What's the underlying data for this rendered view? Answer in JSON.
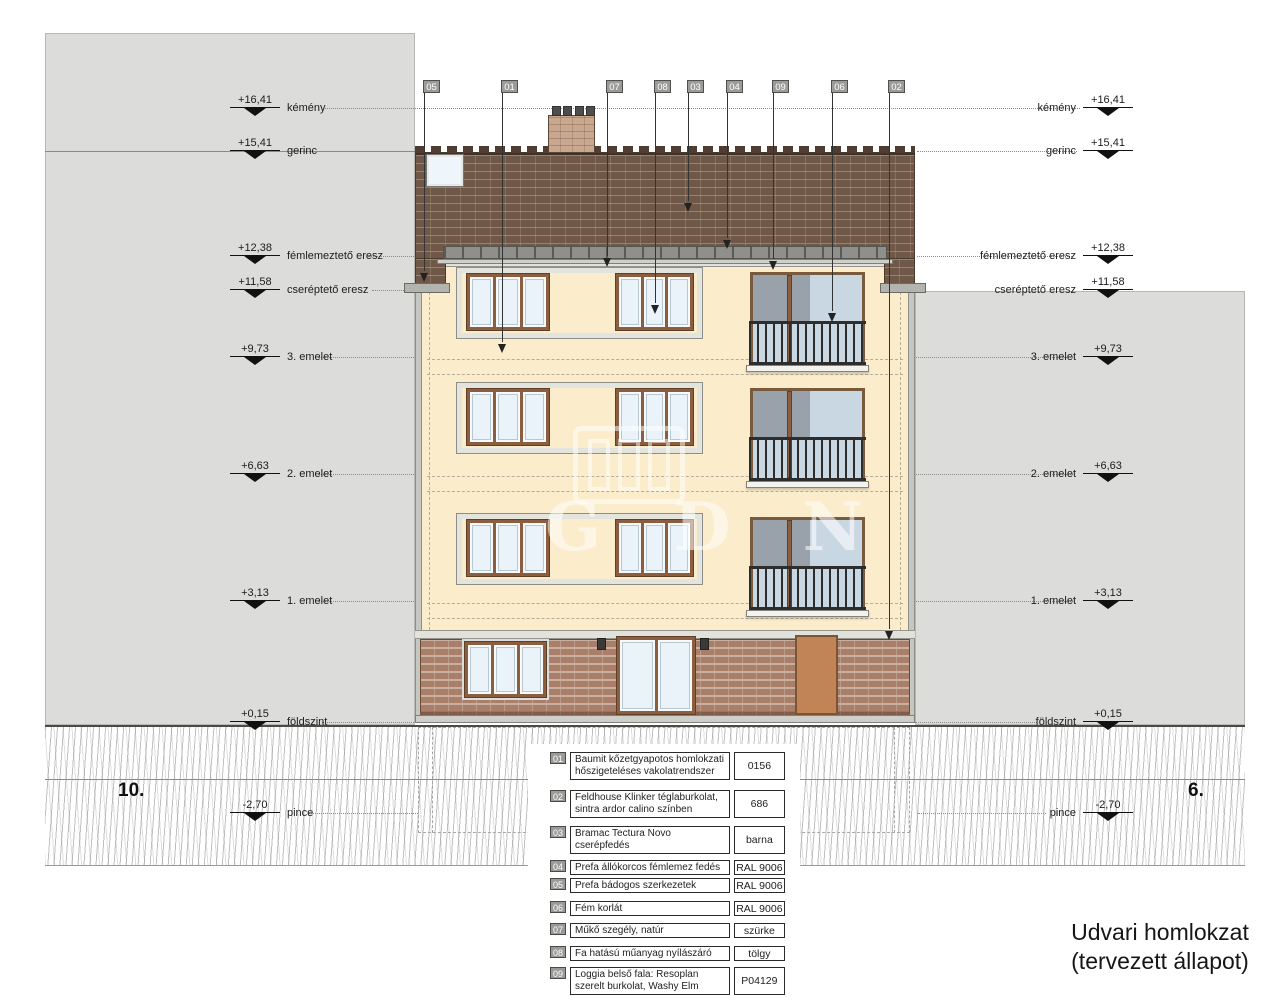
{
  "title": {
    "line1": "Udvari homlokzat",
    "line2": "(tervezett állapot)"
  },
  "side_labels": {
    "left": "10.",
    "right": "6."
  },
  "watermark": {
    "text": "GDN"
  },
  "markers": {
    "left": [
      {
        "value": "+16,41",
        "label": "kémény"
      },
      {
        "value": "+15,41",
        "label": "gerinc"
      },
      {
        "value": "+12,38",
        "label": "fémlemeztető eresz"
      },
      {
        "value": "+11,58",
        "label": "cseréptető eresz"
      },
      {
        "value": "+9,73",
        "label": "3. emelet"
      },
      {
        "value": "+6,63",
        "label": "2. emelet"
      },
      {
        "value": "+3,13",
        "label": "1. emelet"
      },
      {
        "value": "+0,15",
        "label": "földszint"
      },
      {
        "value": "-2,70",
        "label": "pince"
      }
    ],
    "right": [
      {
        "value": "+16,41",
        "label": "kémény"
      },
      {
        "value": "+15,41",
        "label": "gerinc"
      },
      {
        "value": "+12,38",
        "label": "fémlemeztető eresz"
      },
      {
        "value": "+11,58",
        "label": "cseréptető eresz"
      },
      {
        "value": "+9,73",
        "label": "3. emelet"
      },
      {
        "value": "+6,63",
        "label": "2. emelet"
      },
      {
        "value": "+3,13",
        "label": "1. emelet"
      },
      {
        "value": "+0,15",
        "label": "földszint"
      },
      {
        "value": "-2,70",
        "label": "pince"
      }
    ]
  },
  "callouts": [
    {
      "id": "05"
    },
    {
      "id": "01"
    },
    {
      "id": "07"
    },
    {
      "id": "08"
    },
    {
      "id": "03"
    },
    {
      "id": "04"
    },
    {
      "id": "09"
    },
    {
      "id": "06"
    },
    {
      "id": "02"
    }
  ],
  "legend": {
    "rows": [
      {
        "num": "01",
        "desc": "Baumit kőzetgyapotos homlokzati hőszigeteléses vakolatrendszer",
        "value": "0156"
      },
      {
        "num": "02",
        "desc": "Feldhouse Klinker téglaburkolat, sintra ardor calino színben",
        "value": "686"
      },
      {
        "num": "03",
        "desc": "Bramac Tectura Novo cserépfedés",
        "value": "barna"
      },
      {
        "num": "04",
        "desc": "Prefa állókorcos fémlemez fedés",
        "value": "RAL 9006"
      },
      {
        "num": "05",
        "desc": "Prefa bádogos szerkezetek",
        "value": "RAL 9006"
      },
      {
        "num": "06",
        "desc": "Fém korlát",
        "value": "RAL 9006"
      },
      {
        "num": "07",
        "desc": "Műkő szegély, natúr",
        "value": "szürke"
      },
      {
        "num": "08",
        "desc": "Fa hatású műanyag nyílászáró",
        "value": "tölgy"
      },
      {
        "num": "09",
        "desc": "Loggia belső fala: Resoplan szerelt burkolat, Washy Elm",
        "value": "P04129"
      }
    ]
  },
  "colors": {
    "facade_plaster": "#fbeccb",
    "roof_brick": "#6f5847",
    "klinker_brick": "#aa7f69",
    "window_frame": "#8a5e3e",
    "neighbour_grey": "#dcdcda",
    "railing": "#2d2d2d"
  }
}
